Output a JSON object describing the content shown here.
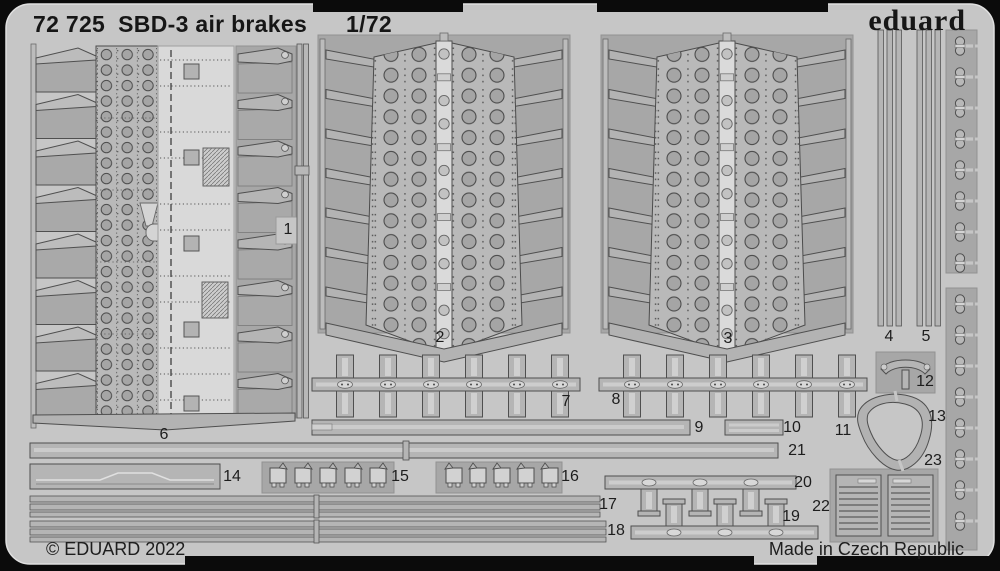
{
  "header": {
    "catalog_number": "72 725",
    "product_name": "SBD-3 air brakes",
    "scale": "1/72",
    "brand": "eduard"
  },
  "footer": {
    "copyright": "© EDUARD 2022",
    "origin": "Made in Czech Republic"
  },
  "parts": {
    "labels": [
      "1",
      "2",
      "3",
      "4",
      "5",
      "6",
      "7",
      "8",
      "9",
      "10",
      "11",
      "12",
      "13",
      "14",
      "15",
      "16",
      "17",
      "18",
      "19",
      "20",
      "21",
      "22",
      "23"
    ]
  },
  "colors": {
    "background": "#0b0b0b",
    "sheet": "#c6c6c6",
    "recess": "#a7a7a7",
    "part_metal": "#b5b5b5",
    "etch_light": "#d9d9d9",
    "outline": "#4f4f4f",
    "text": "#1c1c1c"
  }
}
